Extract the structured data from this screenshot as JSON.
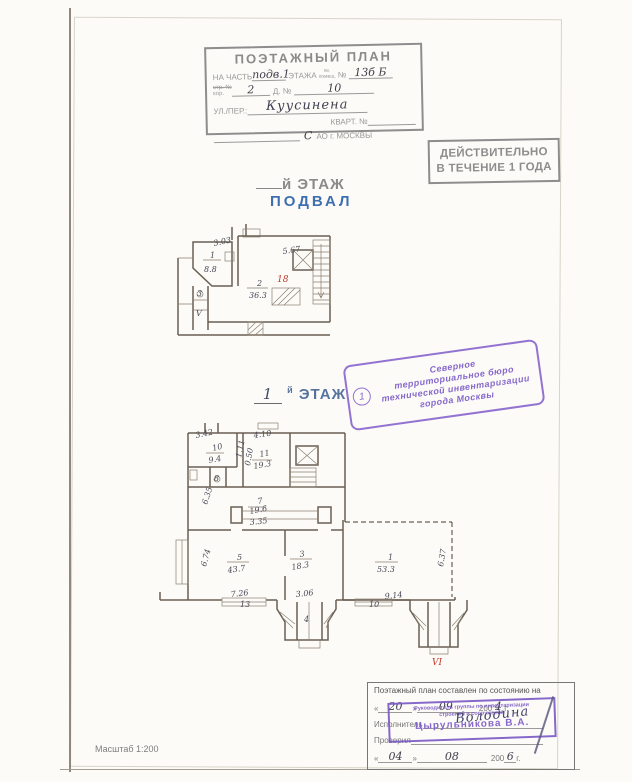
{
  "header_form": {
    "title": "ПОЭТАЖНЫЙ ПЛАН",
    "line1_prefix": "НА ЧАСТЬ",
    "line1_floor_value": "подв.1",
    "line1_mid": "ЭТАЖА",
    "line1_kv": "кв.",
    "line1_pomesch": "помещ.",
    "line1_no": "№",
    "line1_no_value": "13б Б",
    "line2_str": "стр. №",
    "line2_kor": "кор.",
    "line2_str_value": "2",
    "line2_d": "Д. №",
    "line2_d_value": "10",
    "line3_label": "УЛ./ПЕР.:",
    "line3_value": "Куусинена",
    "line4_label": "КВАРТ. №",
    "line5_value": "С",
    "line5_label": "АО г. МОСКВЫ"
  },
  "validity_stamp": {
    "line1": "ДЕЙСТВИТЕЛЬНО",
    "line2": "В ТЕЧЕНИЕ 1 ГОДА"
  },
  "basement_heading": {
    "suffix": "й ЭТАЖ",
    "name": "ПОДВАЛ"
  },
  "first_floor_heading": {
    "number": "1",
    "sup": "й",
    "suffix": "ЭТАЖ"
  },
  "bureau_stamp": {
    "number": "1",
    "lines": [
      "Северное",
      "территориальное бюро",
      "технической инвентаризации",
      "города Москвы"
    ]
  },
  "basement": {
    "labels": [
      {
        "text": "3.03",
        "x": 214,
        "y": 246,
        "rot": -12
      },
      {
        "text": "1",
        "x": 210,
        "y": 258
      },
      {
        "text": "8.8",
        "x": 204,
        "y": 272
      },
      {
        "text": "5.67",
        "x": 283,
        "y": 254,
        "rot": -8
      },
      {
        "text": "2",
        "x": 257,
        "y": 286
      },
      {
        "text": "36.3",
        "x": 249,
        "y": 298
      },
      {
        "text": "18",
        "x": 277,
        "y": 282,
        "cls": "red"
      },
      {
        "text": "3",
        "x": 197,
        "y": 296
      },
      {
        "text": "V",
        "x": 196,
        "y": 316
      }
    ]
  },
  "first_floor": {
    "labels": [
      {
        "text": "3.42",
        "x": 196,
        "y": 438,
        "rot": -12
      },
      {
        "text": "10",
        "x": 213,
        "y": 451,
        "rot": -14
      },
      {
        "text": "9.4",
        "x": 209,
        "y": 463,
        "rot": -10
      },
      {
        "text": "1.11",
        "x": 241,
        "y": 458,
        "rot": -78
      },
      {
        "text": "0.50",
        "x": 250,
        "y": 466,
        "rot": -80
      },
      {
        "text": "4.10",
        "x": 254,
        "y": 438,
        "rot": -8
      },
      {
        "text": "11",
        "x": 260,
        "y": 457,
        "rot": -10
      },
      {
        "text": "19.3",
        "x": 254,
        "y": 469,
        "rot": -10
      },
      {
        "text": "8",
        "x": 214,
        "y": 481
      },
      {
        "text": "6.35",
        "x": 207,
        "y": 505,
        "rot": -72
      },
      {
        "text": "7",
        "x": 258,
        "y": 504,
        "rot": -10
      },
      {
        "text": "19.6",
        "x": 250,
        "y": 514,
        "rot": -10
      },
      {
        "text": "3.35",
        "x": 250,
        "y": 525,
        "rot": -6
      },
      {
        "text": "6.74",
        "x": 206,
        "y": 567,
        "rot": -75
      },
      {
        "text": "5",
        "x": 237,
        "y": 560
      },
      {
        "text": "43.7",
        "x": 228,
        "y": 573,
        "rot": -8
      },
      {
        "text": "3",
        "x": 300,
        "y": 557,
        "rot": -10
      },
      {
        "text": "18.3",
        "x": 292,
        "y": 570,
        "rot": -10
      },
      {
        "text": "1",
        "x": 388,
        "y": 560
      },
      {
        "text": "53.3",
        "x": 377,
        "y": 572
      },
      {
        "text": "6.37",
        "x": 443,
        "y": 567,
        "rot": -80
      },
      {
        "text": "7.26",
        "x": 231,
        "y": 597,
        "rot": -6
      },
      {
        "text": "13",
        "x": 240,
        "y": 607
      },
      {
        "text": "3.06",
        "x": 296,
        "y": 597,
        "rot": -6
      },
      {
        "text": "4",
        "x": 304,
        "y": 622
      },
      {
        "text": "9.14",
        "x": 385,
        "y": 599,
        "rot": -6
      },
      {
        "text": "10",
        "x": 369,
        "y": 607
      },
      {
        "text": "VI",
        "x": 432,
        "y": 665,
        "cls": "red"
      }
    ]
  },
  "footer": {
    "title": "Поэтажный план составлен по состоянию на",
    "q_open": "«",
    "q_close": "»",
    "date1_day": "20",
    "date1_month": "09",
    "date1_century": "200",
    "date1_year": "4",
    "date1_g": "г.",
    "executor_label": "Исполнитель",
    "executor_sign": "Володина",
    "checker_label": "Проверил",
    "date2_day": "04",
    "date2_month": "08",
    "date2_century": "200",
    "date2_year": "6",
    "date2_g": "г.",
    "stamp_line1": "Руководитель группы по инвентаризации",
    "stamp_line2": "строений и сооружений",
    "stamp_name": "Цырульникова В.А."
  },
  "scale_label": "Масштаб 1:200"
}
